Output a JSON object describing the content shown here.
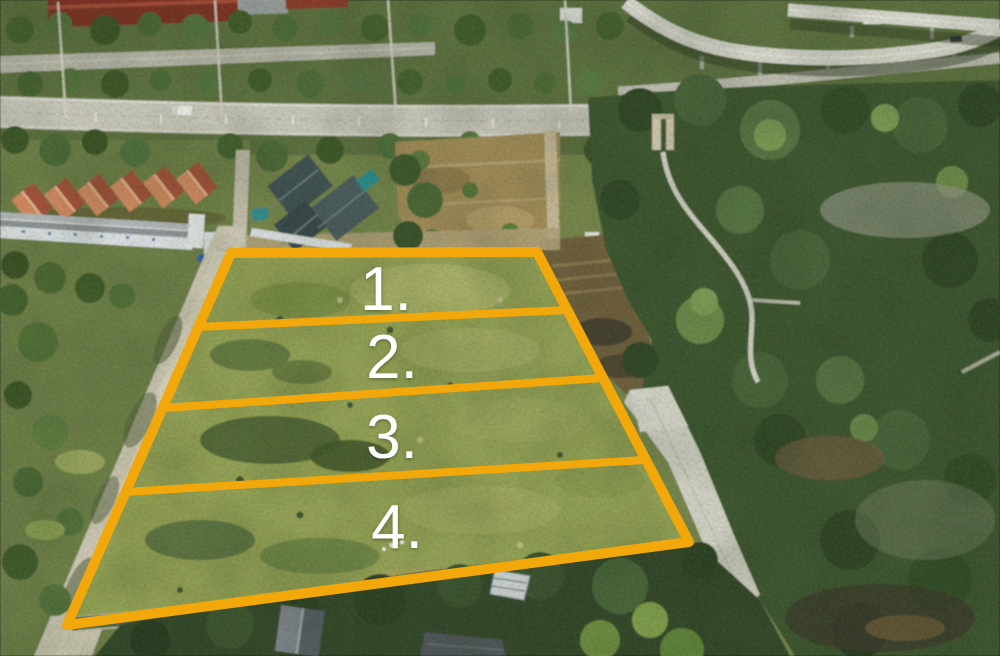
{
  "meta": {
    "type": "aerial-drone-photograph",
    "subject": "Aerial view of subdivided land for sale: four numbered plots outlined in yellow beside a highway interchange"
  },
  "annotations": {
    "boundary_color": "#F2A70A",
    "label_color": "#FFFFFF",
    "plots": [
      {
        "label": "1."
      },
      {
        "label": "2."
      },
      {
        "label": "3."
      },
      {
        "label": "4."
      }
    ]
  }
}
